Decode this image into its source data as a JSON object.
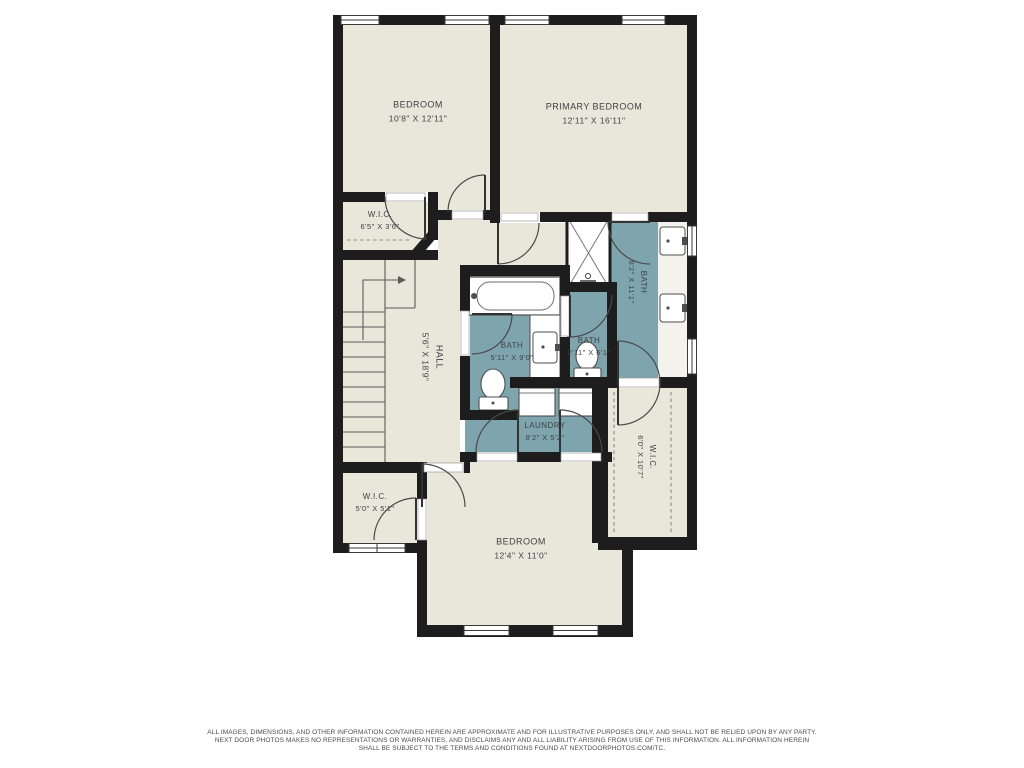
{
  "document": {
    "type": "second-floor residential floor plan",
    "colors": {
      "background": "#ffffff",
      "floor": "#e9e6da",
      "wet_room_floor": "#7ea5ae",
      "wall": "#1d1d1e",
      "label_text": "#3f4347"
    }
  },
  "rooms": [
    {
      "id": "bedroom-top",
      "name": "BEDROOM",
      "dims": "10'8\" X 12'11\""
    },
    {
      "id": "primary-bedroom",
      "name": "PRIMARY BEDROOM",
      "dims": "12'11\" X 16'11\""
    },
    {
      "id": "wic-top",
      "name": "W.I.C.",
      "dims": "6'5\" X 3'6\""
    },
    {
      "id": "hall",
      "name": "HALL",
      "dims": "5'6\" X 18'9\""
    },
    {
      "id": "bath-main",
      "name": "BATH",
      "dims": "5'11\" X 9'0\""
    },
    {
      "id": "bath-small",
      "name": "BATH",
      "dims": "2'11\" X 6'1\""
    },
    {
      "id": "bath-primary",
      "name": "BATH",
      "dims": "8'2\" X 11'1\""
    },
    {
      "id": "laundry",
      "name": "LAUNDRY",
      "dims": "8'2\" X 5'2\""
    },
    {
      "id": "wic-right",
      "name": "W.I.C.",
      "dims": "6'0\" X 10'7\""
    },
    {
      "id": "wic-bottom-left",
      "name": "W.I.C.",
      "dims": "5'0\" X 5'1\""
    },
    {
      "id": "bedroom-bottom",
      "name": "BEDROOM",
      "dims": "12'4\" X 11'0\""
    }
  ],
  "fixtures": [
    "stairs",
    "bathtub",
    "shower",
    "toilet",
    "sink-vanity",
    "washer",
    "dryer",
    "closet-rod",
    "windows",
    "door-swings"
  ],
  "disclaimer": {
    "line1": "ALL IMAGES, DIMENSIONS, AND OTHER INFORMATION CONTAINED HEREIN ARE APPROXIMATE AND FOR ILLUSTRATIVE PURPOSES ONLY, AND SHALL NOT BE RELIED UPON BY ANY PARTY.",
    "line2": "NEXT DOOR PHOTOS MAKES NO REPRESENTATIONS OR WARRANTIES, AND DISCLAIMS ANY AND ALL LIABILITY ARISING FROM USE OF THIS INFORMATION. ALL INFORMATION HEREIN",
    "line3": "SHALL BE SUBJECT TO THE TERMS AND CONDITIONS FOUND AT NEXTDOORPHOTOS.COM/TC."
  }
}
